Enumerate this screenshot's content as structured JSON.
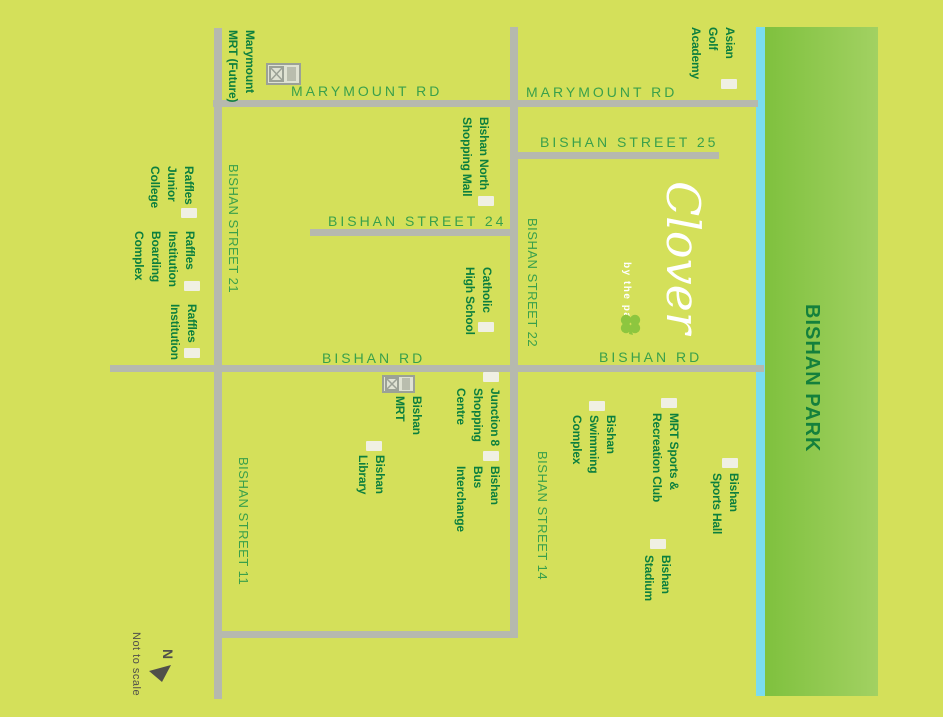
{
  "colors": {
    "bg": "#d4e05a",
    "road": "#b6b9ae",
    "river": "#7adcf0",
    "park-start": "#7fc13e",
    "park-end": "#a2d162",
    "street-text": "#3aa04b",
    "place-text": "#0c7f3e",
    "park-text": "#14803c",
    "compass-text": "#50504a",
    "marker": "#f0f0e3",
    "logo": "#ffffff",
    "clover-green": "#8dc63f",
    "mrt-icon-frame": "#9ba196",
    "mrt-icon-fill": "#dfe2d3"
  },
  "logo": {
    "name": "Clover",
    "tagline": "by the park"
  },
  "park": {
    "label": "BISHAN PARK"
  },
  "compass": {
    "north": "N",
    "note": "Not to scale"
  },
  "streets": {
    "marymount_rd_a": "MARYMOUNT RD",
    "marymount_rd_b": "MARYMOUNT RD",
    "bishan_st_25": "BISHAN STREET 25",
    "bishan_st_24": "BISHAN STREET 24",
    "bishan_st_22": "BISHAN STREET 22",
    "bishan_st_21": "BISHAN STREET 21",
    "bishan_st_14": "BISHAN STREET 14",
    "bishan_st_11": "BISHAN STREET 11",
    "bishan_rd_a": "BISHAN RD",
    "bishan_rd_b": "BISHAN RD"
  },
  "places": {
    "marymount_mrt": "Marymount\nMRT (Future)",
    "asian_golf": "Asian\nGolf\nAcademy",
    "bishan_north_mall": "Bishan North\nShopping Mall",
    "raffles_jc": "Raffles\nJunior\nCollege",
    "raffles_boarding": "Raffles\nInstitution\nBoarding\nComplex",
    "raffles_inst": "Raffles\nInstitution",
    "catholic_high": "Catholic\nHigh School",
    "bishan_mrt": "Bishan\nMRT",
    "junction8": "Junction 8\nShopping\nCentre",
    "bishan_library": "Bishan\nLibrary",
    "bus_interchange": "Bishan\nBus\nInterchange",
    "mrt_sports_club": "MRT Sports &\nRecreation Club",
    "swimming_complex": "Bishan\nSwimming\nComplex",
    "sports_hall": "Bishan\nSports Hall",
    "stadium": "Bishan\nStadium"
  }
}
